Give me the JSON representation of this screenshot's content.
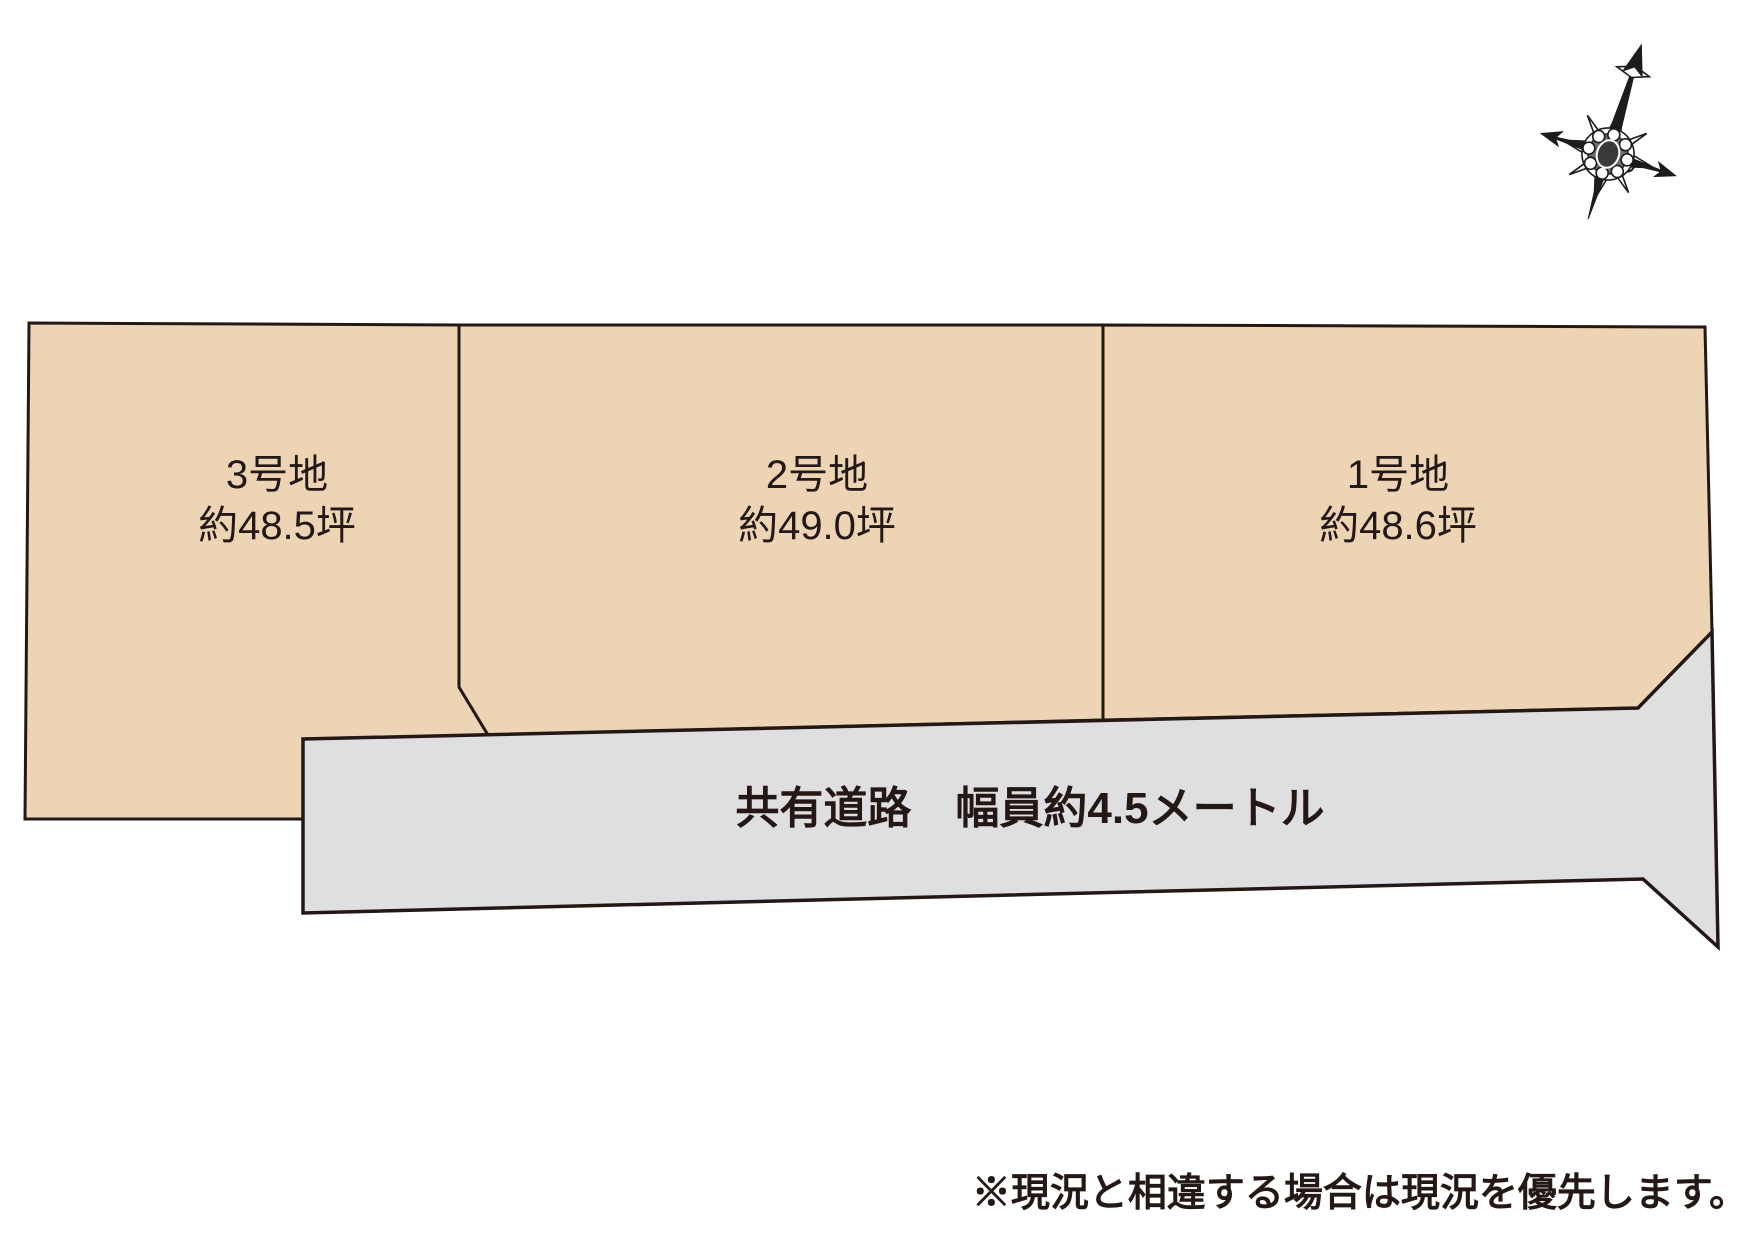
{
  "diagram": {
    "plots": [
      {
        "name": "3号地",
        "area": "約48.5坪"
      },
      {
        "name": "2号地",
        "area": "約49.0坪"
      },
      {
        "name": "1号地",
        "area": "約48.6坪"
      }
    ],
    "road_label": "共有道路　幅員約4.5メートル",
    "note": "※現況と相違する場合は現況を優先します。",
    "icons": {
      "compass": "north-compass-rose"
    },
    "colors": {
      "plot_fill": "#ECD4B4",
      "road_fill": "#DFDFE1",
      "line": "#231815",
      "text": "#231815",
      "compass": "#1C1C1C",
      "background": "#FFFFFF"
    }
  }
}
